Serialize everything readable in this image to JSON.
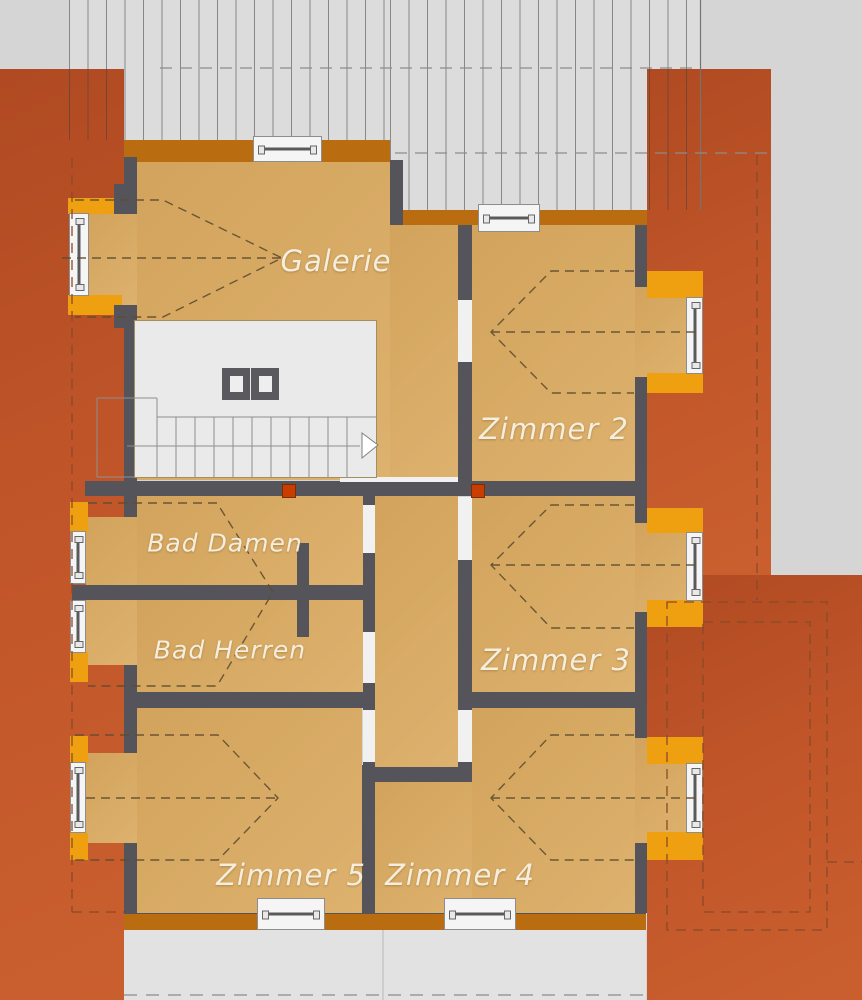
{
  "plan": {
    "type": "floor-plan",
    "rooms": [
      {
        "id": "galerie",
        "label": "Galerie"
      },
      {
        "id": "zimmer-2",
        "label": "Zimmer 2"
      },
      {
        "id": "zimmer-3",
        "label": "Zimmer 3"
      },
      {
        "id": "bad-damen",
        "label": "Bad Damen"
      },
      {
        "id": "bad-herren",
        "label": "Bad Herren"
      },
      {
        "id": "zimmer-5",
        "label": "Zimmer 5"
      },
      {
        "id": "zimmer-4",
        "label": "Zimmer 4"
      }
    ]
  },
  "colors": {
    "background": "#d5d5d6",
    "roof_fill": "#dcdcdd",
    "terrace": "#bc5226",
    "band": "#b96c10",
    "bay_frame": "#efa011",
    "room_fill": "#d9ac66",
    "wall": "#54545a",
    "stair_area": "#eaeaeb",
    "window_white": "#f5f5f6",
    "door_marker": "#c93e00",
    "label_text": "#f6eedd",
    "lower_strip": "#e2e2e3"
  }
}
